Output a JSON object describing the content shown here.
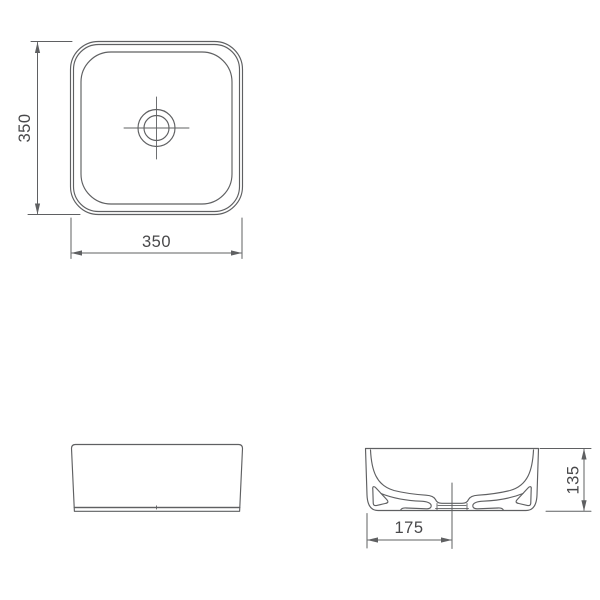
{
  "colors": {
    "line": "#5f6062",
    "text": "#48484a",
    "base_shadow": "#9b9c9e",
    "background": "#ffffff"
  },
  "views": {
    "top_view": {
      "height_dim": "350",
      "width_dim": "350"
    },
    "section_view": {
      "height_dim": "135",
      "drain_center_dim": "175"
    }
  }
}
